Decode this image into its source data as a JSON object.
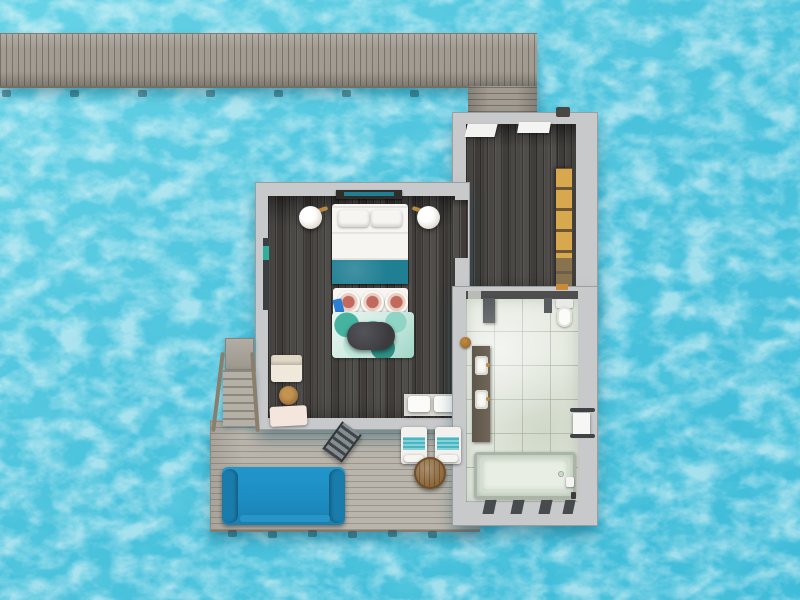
{
  "scene": {
    "title": "Overwater villa floor plan - aerial top-down view",
    "render_type": "3d floor plan over turquoise lagoon",
    "no_visible_text": true
  },
  "colors": {
    "waterLight": "#6fd6e8",
    "waterMid": "#4cc3dd",
    "waterDeep": "#3db8d6",
    "jetty": "#a19b91",
    "deck": "#bab5ac",
    "wall": "#c8c9cb",
    "floorDark": "#474441",
    "tile": "#e4e9df",
    "bedTeal": "#207f93",
    "sofaBlue": "#1d8dc2",
    "wardrobeAmber": "#d8a84e",
    "rugTeal": "#57b8a5",
    "woodTable": "#a87a45",
    "pillowRose": "#c0695c",
    "brass": "#b98a3e",
    "rail": "#8a7e6d",
    "towelTeal": "#49b7c2"
  },
  "rooms": [
    {
      "id": "jetty",
      "label": "arrival jetty with side walkway"
    },
    {
      "id": "entry-hall",
      "label": "entry corridor / dressing area with wardrobe"
    },
    {
      "id": "bedroom",
      "label": "bedroom with king bed, lamps, lounge corner"
    },
    {
      "id": "bathroom",
      "label": "bathroom with double vanity, toilet, bathtub"
    },
    {
      "id": "deck",
      "label": "sun deck with daybed, loungers and sea stairs"
    }
  ],
  "furniture": [
    "headboard-console",
    "king-bed",
    "bed-pillows",
    "teal-bed-runner",
    "wall-lamp-left",
    "wall-lamp-right",
    "foot-bench",
    "round-cushions",
    "area-rug",
    "oval-ottoman",
    "armchair",
    "round-side-table",
    "lounge-cushion",
    "towel-shelf",
    "wall-art",
    "wardrobe-shelves",
    "toilet",
    "double-vanity",
    "wooden-stool",
    "bathtub",
    "towel-rack",
    "slatted-floor",
    "blue-daybed",
    "sun-lounger-1",
    "sun-lounger-2",
    "round-deck-table",
    "sea-ladder",
    "sea-stairs",
    "stair-railings"
  ]
}
